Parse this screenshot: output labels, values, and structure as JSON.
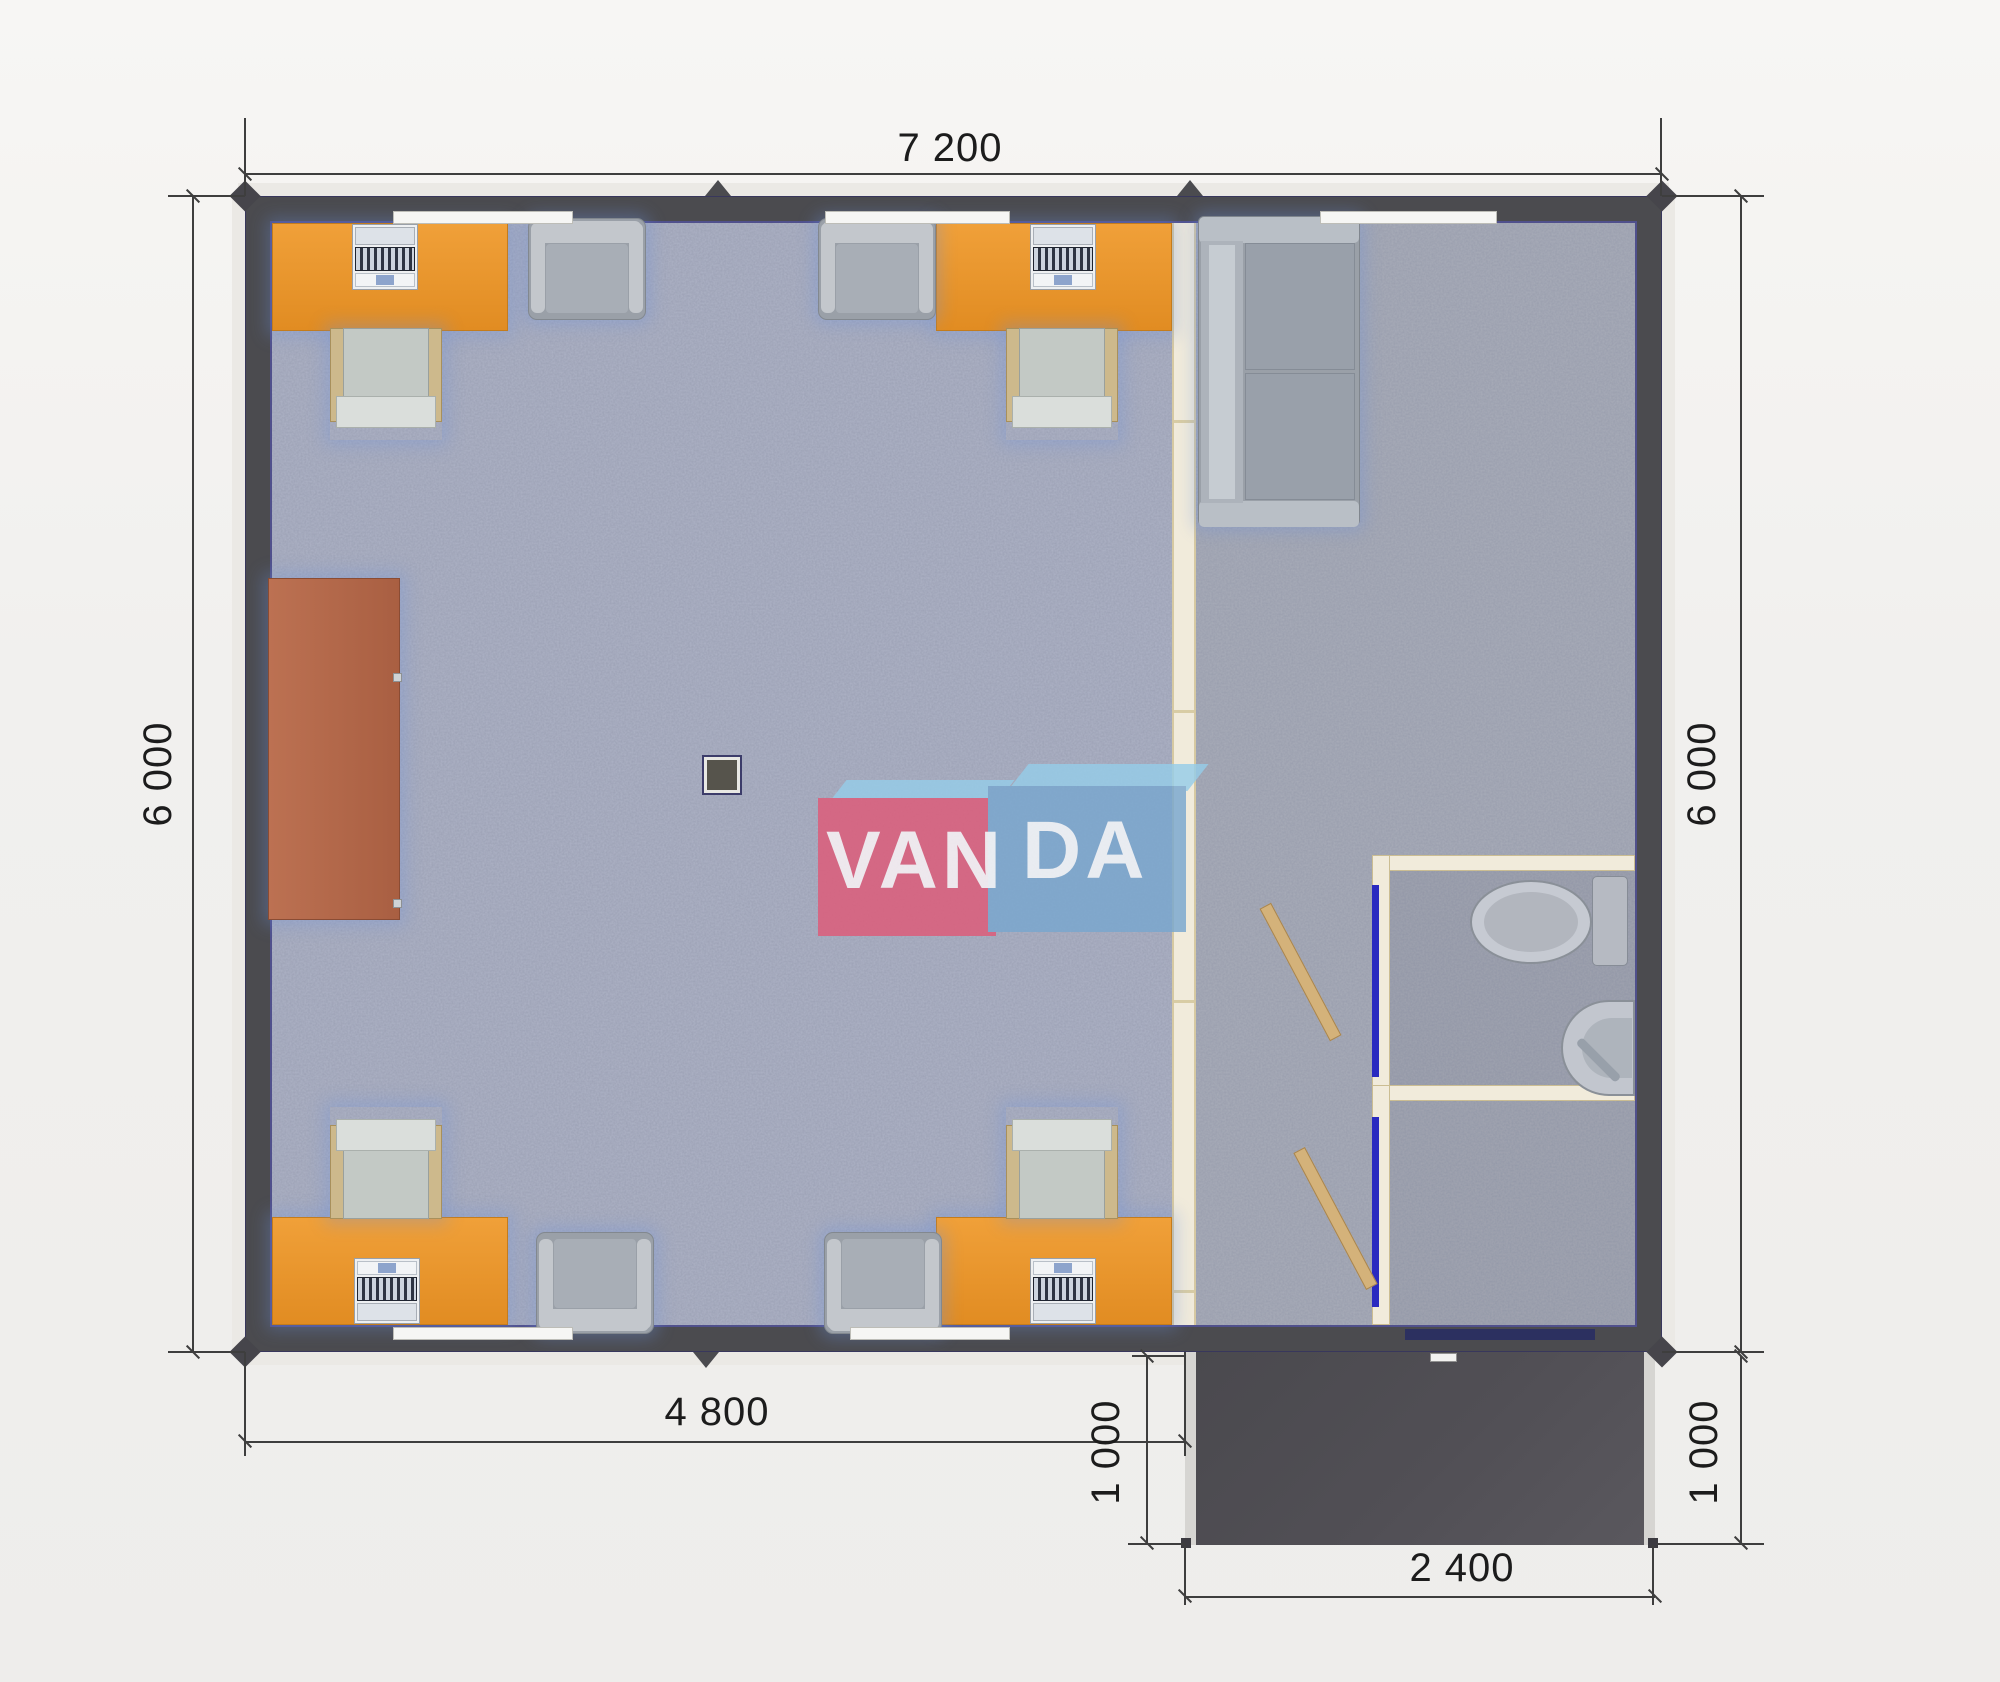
{
  "watermark": {
    "text_left": "VAN",
    "text_right": "DA"
  },
  "dimensions": {
    "top_width": "7 200",
    "left_height": "6 000",
    "right_height": "6 000",
    "bottom_inner_width": "4 800",
    "porch_left_depth": "1 000",
    "porch_right_depth": "1 000",
    "porch_width": "2 400"
  },
  "colors": {
    "wall": "#4b4b4f",
    "floor_office": "#aeb3c6",
    "floor_right": "#a9adb9",
    "desk_orange": "#ec9730",
    "cabinet_brown": "#b2664b",
    "partition_cream": "#f1ebdb",
    "door_frame_blue": "#2a2ac0",
    "door_wood": "#d4b27a",
    "furniture_gray": "#a8aeb6",
    "porch_dark": "#504f54",
    "dimension_text": "#1c1c1c",
    "logo_red": "#df5a78",
    "logo_blue": "#79a7cf",
    "logo_flap": "#96cde9"
  }
}
